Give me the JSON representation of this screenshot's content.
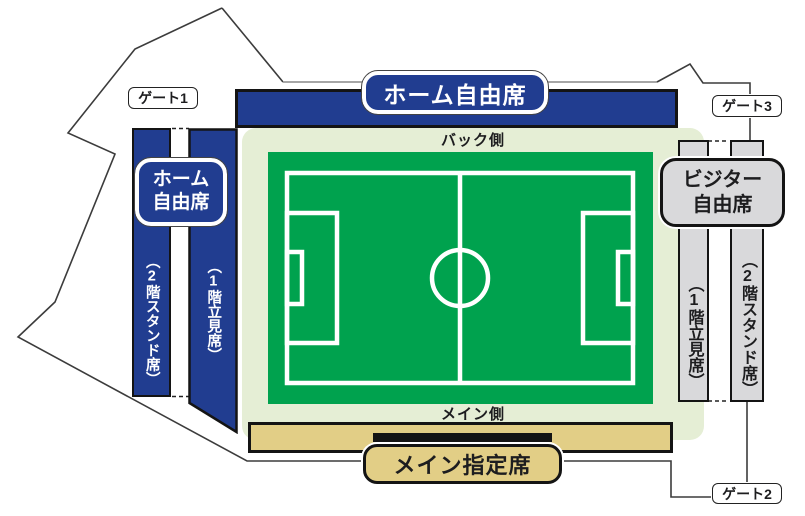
{
  "colors": {
    "navy": "#213d90",
    "pitch_green": "#00a24e",
    "pale_green": "#e5eed5",
    "tan": "#e2ce86",
    "seat_gray": "#d9d9db",
    "ink": "#1d1d1f"
  },
  "gates": {
    "gate1": "ゲート1",
    "gate2": "ゲート2",
    "gate3": "ゲート3"
  },
  "field": {
    "back_side": "バック側",
    "main_side": "メイン側"
  },
  "home_stand": {
    "banner": "ホーム自由席",
    "label_line1": "ホーム",
    "label_line2": "自由席",
    "tier2": "（2階スタンド席）",
    "tier1": "（1階立見席）"
  },
  "visitor_stand": {
    "label_line1": "ビジター",
    "label_line2": "自由席",
    "tier1": "（1階立見席）",
    "tier2": "（2階スタンド席）"
  },
  "main_stand": {
    "label": "メイン指定席"
  }
}
